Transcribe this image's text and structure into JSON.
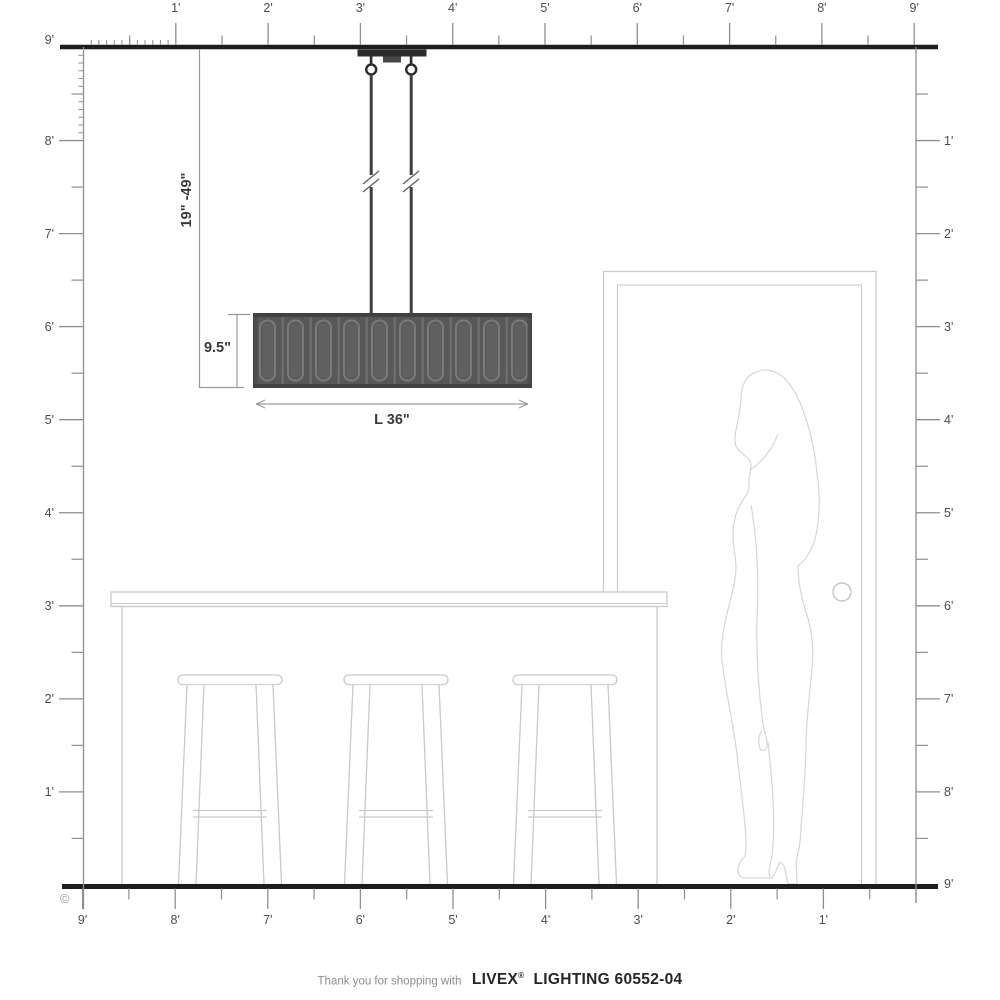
{
  "rulers": {
    "top": [
      "1'",
      "2'",
      "3'",
      "4'",
      "5'",
      "6'",
      "7'",
      "8'",
      "9'"
    ],
    "left": [
      "9'",
      "8'",
      "7'",
      "6'",
      "5'",
      "4'",
      "3'",
      "2'",
      "1'"
    ],
    "right": [
      "1'",
      "2'",
      "3'",
      "4'",
      "5'",
      "6'",
      "7'",
      "8'",
      "9'"
    ],
    "bottom": [
      "9'",
      "8'",
      "7'",
      "6'",
      "5'",
      "4'",
      "3'",
      "2'",
      "1'"
    ]
  },
  "dimensions": {
    "hang_range": "19\" -49\"",
    "shade_height": "9.5\"",
    "shade_length": "L 36\""
  },
  "footer": {
    "copyright": "©",
    "prefix": "Thank you for shopping with",
    "brand": "LIVEX",
    "registered": "®",
    "suffix": "LIGHTING 60552-04"
  },
  "colors": {
    "structure_line": "#1d1d1d",
    "ruler": "#8f8f8f",
    "label": "#4d4d4d",
    "dimension_line": "#9a9a9a",
    "fixture_dark": "#2c2c2c",
    "shade_base": "#585858",
    "furniture_outline": "#c9c9c9",
    "figure_outline": "#d6d6d6"
  }
}
